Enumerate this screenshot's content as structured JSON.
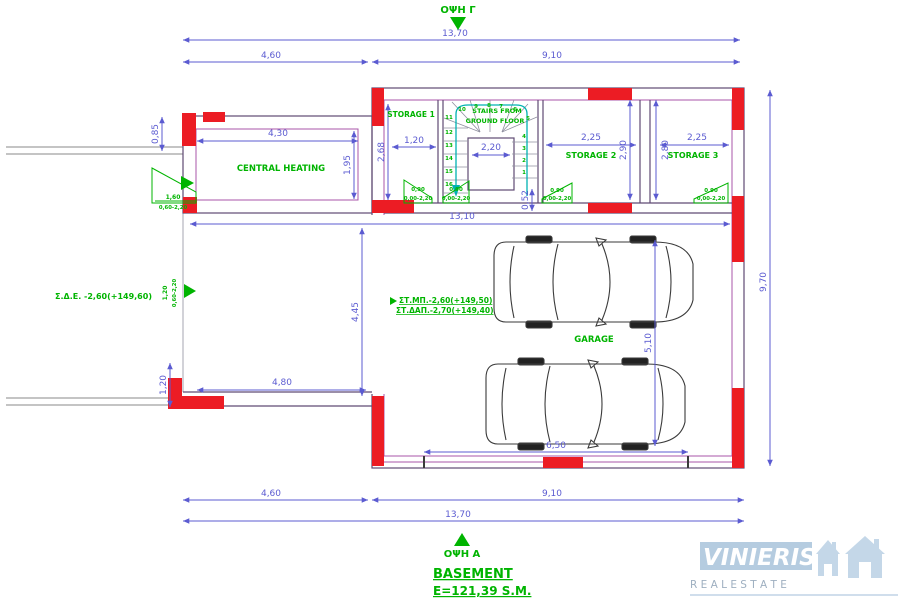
{
  "colors": {
    "dimension_blue": "#5b5bd1",
    "wall_purple": "#5f4a73",
    "wall_magenta": "#a855a8",
    "new_wall_red": "#ec1c24",
    "annotation_green": "#00b400",
    "walkline_teal": "#00b2b2",
    "logo_blue": "#aec7dd",
    "logo_subtitle_gray": "#94a7ba"
  },
  "views": {
    "top": "ΟΨΗ Γ",
    "bottom": "ΟΨΗ Α"
  },
  "title": {
    "name": "BASEMENT",
    "area": "E=121,39 S.M."
  },
  "rooms": {
    "central_heating": "CENTRAL HEATING",
    "storage1": "STORAGE 1",
    "storage2": "STORAGE 2",
    "storage3": "STORAGE 3",
    "garage": "GARAGE",
    "stairs_note_1": "STAIRS FROM",
    "stairs_note_2": "GROUND FLOOR"
  },
  "levels": {
    "side": "Σ.Δ.Ε. -2,60(+149,60)",
    "garage_top": "ΣΤ.ΜΠ.-2,60(+149,50)",
    "garage_bottom": "ΣΤ.ΔΑΠ.-2,70(+149,40)"
  },
  "dimensions": {
    "top_total": "13,70",
    "top_left": "4,60",
    "top_right": "9,10",
    "bottom_total": "13,70",
    "bottom_left": "4,60",
    "bottom_right": "9,10",
    "right_height": "9,70",
    "left_top": "0,85",
    "left_bottom": "1,20",
    "ch_width": "4,30",
    "ch_height": "1,95",
    "s1_width": "1,20",
    "s1_height": "2,68",
    "stairs_width": "2,20",
    "landing": "0,52",
    "s2_width": "2,25",
    "s2_height": "2,90",
    "s3_width": "2,25",
    "s3_height": "2,80",
    "interior_width": "13,10",
    "garage_left": "4,45",
    "drive_width": "4,80",
    "garage_height": "5,10",
    "garage_door": "6,50"
  },
  "openings": {
    "window_ch": {
      "w": "1,60",
      "h": "0,60-2,20"
    },
    "window_left": {
      "w": "1,20",
      "h": "0,60-2,20"
    },
    "door1": {
      "w": "0,90",
      "h": "0,00-2,20"
    },
    "door2": {
      "w": "0,90",
      "h": "0,00-2,20"
    },
    "door3": {
      "w": "0,90",
      "h": "0,00-2,20"
    },
    "door4": {
      "w": "0,90",
      "h": "0,00-2,20"
    }
  },
  "stairs": {
    "numbers": [
      "1",
      "2",
      "3",
      "4",
      "5",
      "6",
      "7",
      "8",
      "9",
      "10",
      "11",
      "12",
      "13",
      "14",
      "15",
      "16"
    ]
  },
  "logo": {
    "brand": "VINIERIS",
    "subtitle": "R E A L   E S T A T E"
  }
}
